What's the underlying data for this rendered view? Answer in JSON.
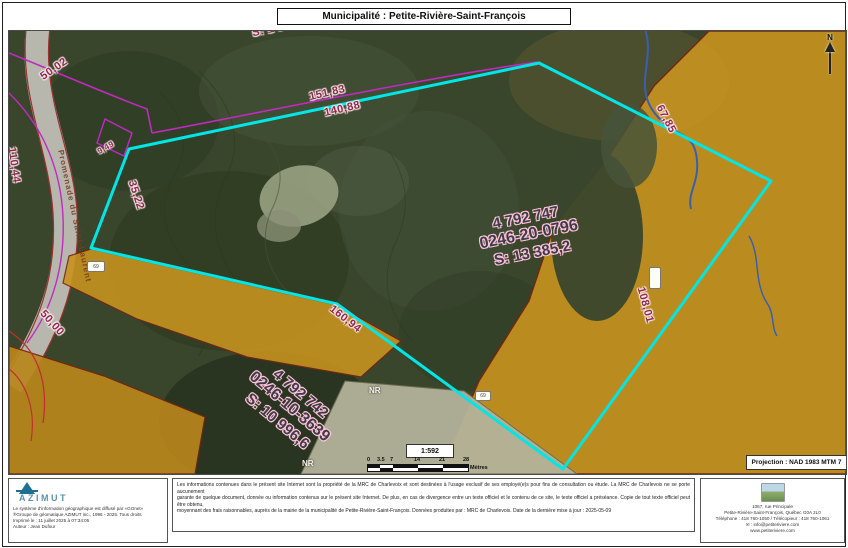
{
  "header": {
    "title": "Municipalité : Petite-Rivière-Saint-François"
  },
  "map": {
    "parcel_main": {
      "lot": "4 792 747",
      "matricule": "0246-20-0796",
      "area": "S: 13 385,2"
    },
    "parcel_second": {
      "lot": "4 792 742",
      "matricule": "0246-10-3639",
      "area": "S: 10 996,6"
    },
    "measurements": [
      {
        "text": "50,02"
      },
      {
        "text": "S: 1 0"
      },
      {
        "text": "151,83"
      },
      {
        "text": "140,88"
      },
      {
        "text": "110,44"
      },
      {
        "text": "9,49"
      },
      {
        "text": "35,22"
      },
      {
        "text": "67,85"
      },
      {
        "text": "50,00"
      },
      {
        "text": "160,94"
      },
      {
        "text": "108,01"
      }
    ],
    "street_label": "Promenade du Saint-Laurent",
    "zone_labels": [
      "NR",
      "NR"
    ],
    "badges": [
      {
        "text": "69"
      },
      {
        "text": "69"
      },
      {
        "text": ""
      }
    ],
    "north_label": "N",
    "scale": {
      "ratio": "1:592",
      "ticks": [
        "0",
        "3.5",
        "7",
        "14",
        "21",
        "28"
      ],
      "unit": "Mètres"
    },
    "projection": "Projection : NAD 1983 MTM 7"
  },
  "footer": {
    "azimut": {
      "brand": "AZIMUT",
      "lines": [
        "Le système d'information géographique est diffusé par «GOnet»",
        "®Groupe de géomatique AZIMUT inc., 1996 - 2025. Tous droits",
        "Imprimé le : 11 juillet 2025 à 07:34:05",
        "Auteur : Jean Dufour"
      ]
    },
    "disclaimer": {
      "lines": [
        "Les informations contenues dans le présent site Internet sont la propriété de la MRC de Charlevoix et sont destinées à l'usage exclusif de ses employé(e)s pour fins de consultation ou étude. La MRC de Charlevoix ne se porte aucunement",
        "garante de quelque document, donnée ou information contenus sur le présent site Internet. De plus, en cas de divergence entre un texte officiel et le contenu de ce site, le texte officiel a préséance. Copie de tout texte officiel peut être obtenu,",
        "moyennant des frais raisonnables, auprès de la mairie de la municipalité de Petite-Rivière-Saint-François. Données produites par : MRC de Charlevoix. Date de la dernière mise à jour : 2025-05-09"
      ]
    },
    "contact": {
      "lines": [
        "1067, rue Principale",
        "Petite-Rivière-Saint-François, Québec G0A 2L0",
        "Téléphone : 418 760-1050 / Télécopieur : 418 760-1061",
        "✉ : info@petiteriviere.com",
        "www.petiteriviere.com"
      ]
    }
  },
  "colors": {
    "selection_cyan": "#00e6e6",
    "zoning_ochre": "#c6931f",
    "zone_beige": "#b3b29a",
    "measurement_text": "#8c2a4a",
    "cadastre_magenta": "#c02ac0",
    "boundary_darkred": "#7a2410"
  }
}
